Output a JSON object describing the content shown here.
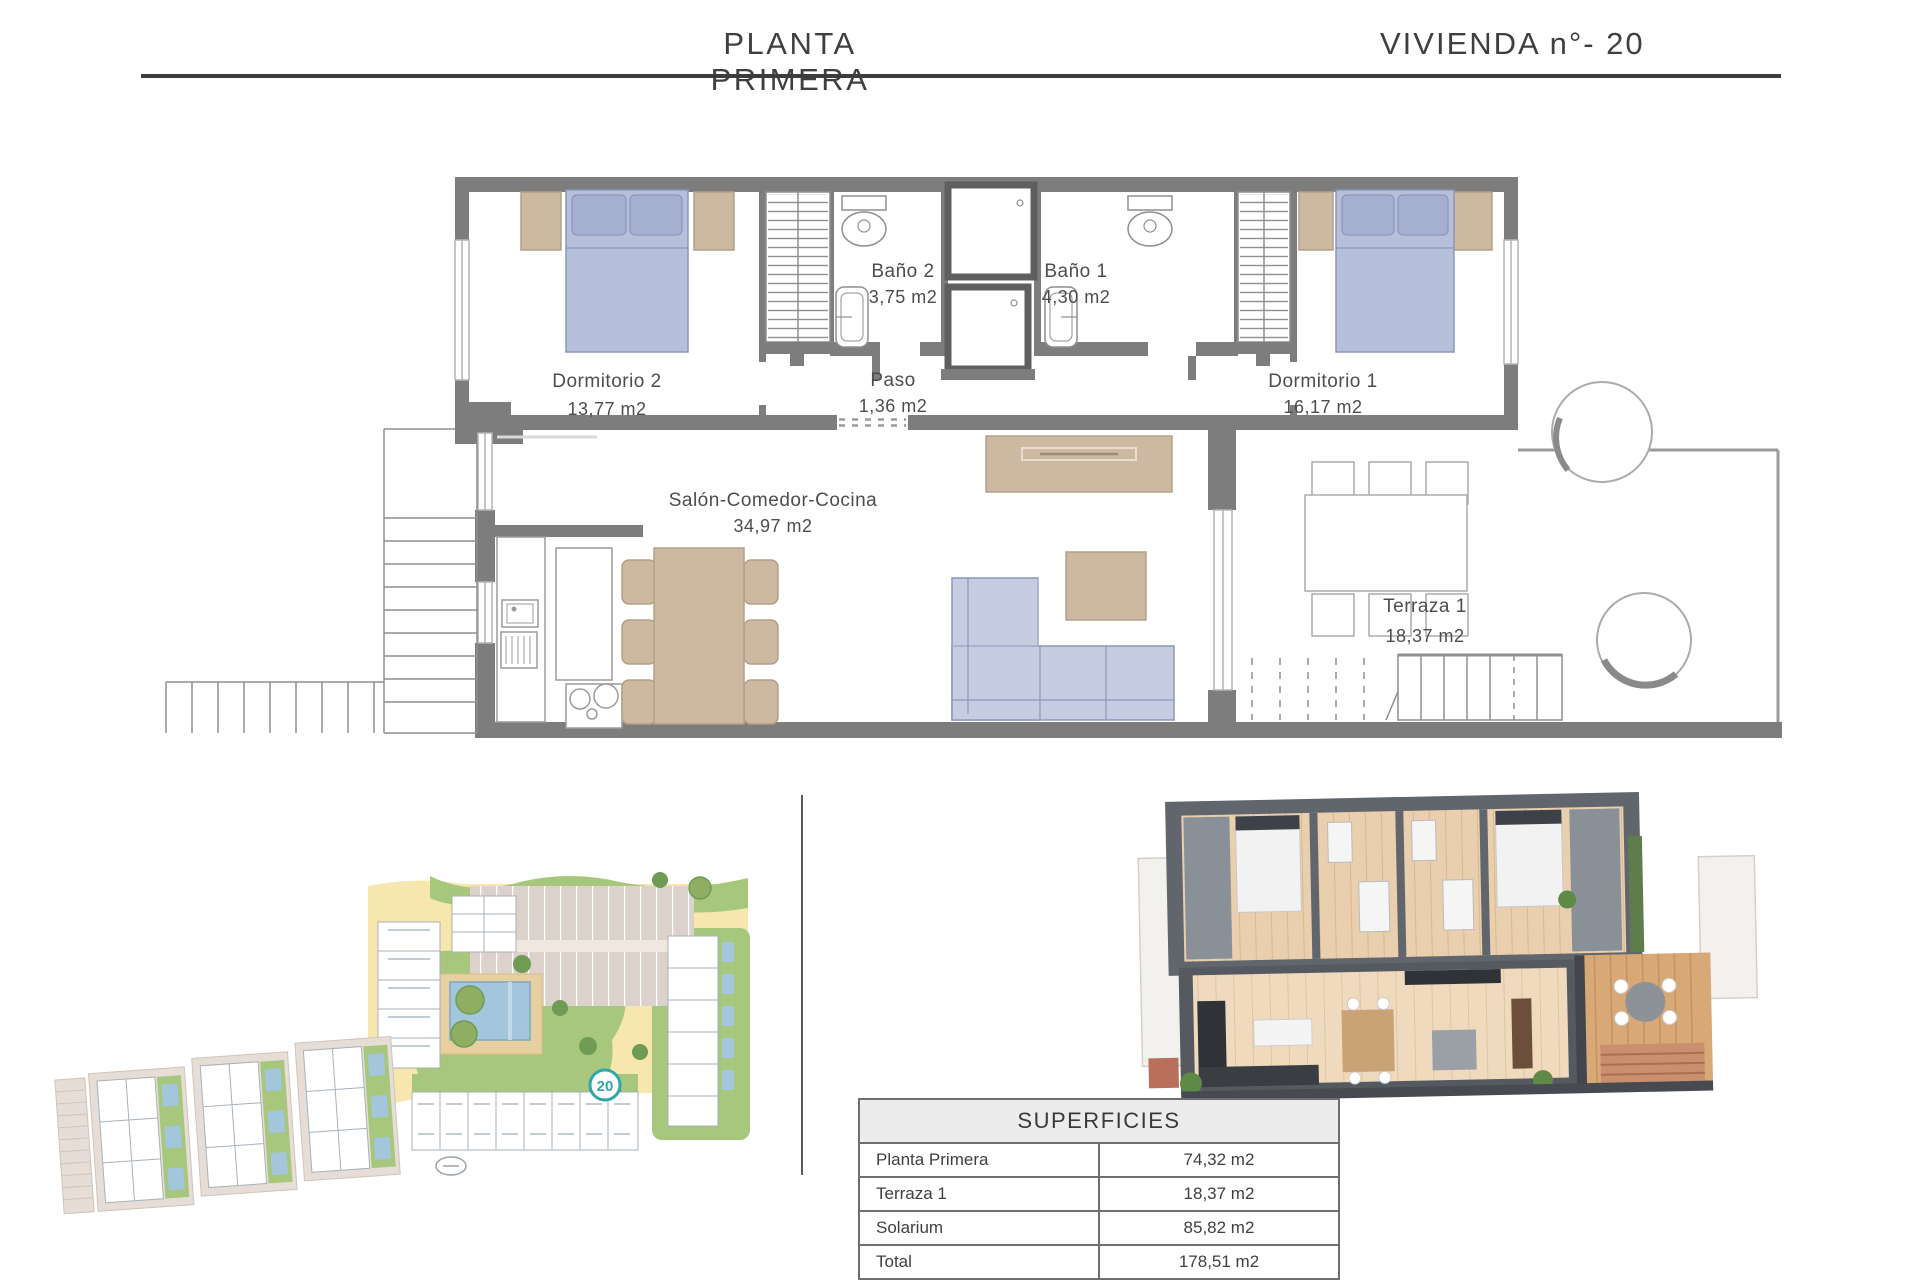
{
  "header": {
    "title": "PLANTA PRIMERA",
    "unit": "VIVIENDA n°- 20"
  },
  "floor_plan": {
    "rooms": [
      {
        "name": "Dormitorio 2",
        "area": "13,77 m2"
      },
      {
        "name": "Baño 2",
        "area": "3,75 m2"
      },
      {
        "name": "Paso",
        "area": "1,36 m2"
      },
      {
        "name": "Baño 1",
        "area": "4,30 m2"
      },
      {
        "name": "Dormitorio 1",
        "area": "16,17 m2"
      },
      {
        "name": "Salón-Comedor-Cocina",
        "area": "34,97 m2"
      },
      {
        "name": "Terraza 1",
        "area": "18,37 m2"
      }
    ]
  },
  "site_plan": {
    "unit_marker": "20"
  },
  "surfaces_table": {
    "title": "SUPERFICIES",
    "rows": [
      {
        "label": "Planta Primera",
        "value": "74,32 m2"
      },
      {
        "label": "Terraza 1",
        "value": "18,37 m2"
      },
      {
        "label": "Solarium",
        "value": "85,82 m2"
      },
      {
        "label": "Total",
        "value": "178,51 m2"
      }
    ]
  },
  "colors": {
    "wall": "#7d7d7d",
    "accent_teal": "#2fa7a9",
    "furniture_blue": "#c3cbdf",
    "furniture_tan": "#cdb9a2",
    "site_yellow": "#f7e7ae",
    "site_green": "#a6c77c",
    "pool_blue": "#a3c6dd"
  }
}
